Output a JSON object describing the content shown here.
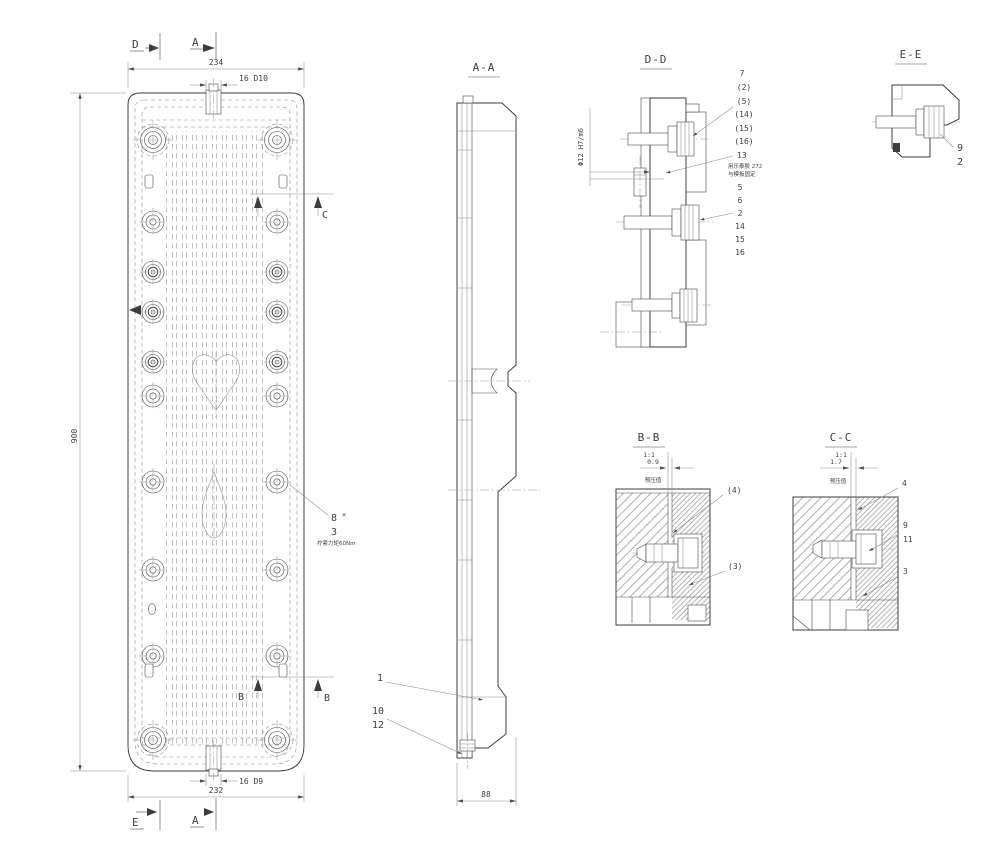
{
  "front": {
    "marker_d_top": "D",
    "marker_a_top": "A",
    "marker_e_bottom": "E",
    "marker_a_bottom": "A",
    "marker_c_right": "C",
    "marker_b_right": "B",
    "marker_b_inner": "B",
    "dim_width_top": "234",
    "dim_slot_top": "16 D10",
    "dim_height": "900",
    "dim_width_bottom": "232",
    "dim_slot_bottom": "16 D9",
    "callout_8": "8",
    "callout_8_mark": "×",
    "callout_3": "3",
    "torque_note": "拧紧力矩60Nm"
  },
  "section_aa": {
    "title": "A-A",
    "dim_depth": "88",
    "callout_1": "1",
    "callout_10": "10",
    "callout_12": "12"
  },
  "section_dd": {
    "title": "D-D",
    "fit_note": "Φ12 H7/m6",
    "callouts_upper": [
      "7",
      "(2)",
      "(5)",
      "(14)",
      "(15)",
      "(16)"
    ],
    "callout_13": "13",
    "glue_note_line1": "用乐泰胶 272",
    "glue_note_line2": "与模板固定",
    "callouts_lower": [
      "5",
      "6",
      "2",
      "14",
      "15",
      "16"
    ]
  },
  "section_ee": {
    "title": "E-E",
    "callout_9": "9",
    "callout_2": "2"
  },
  "section_bb": {
    "title": "B-B",
    "scale": "1:1",
    "dim_gap": "0.9",
    "dim_note": "预压值",
    "callout_4": "(4)",
    "callout_3": "(3)"
  },
  "section_cc": {
    "title": "C-C",
    "scale": "1:1",
    "dim_gap": "1.7",
    "dim_note": "预压值",
    "callout_4": "4",
    "callout_9": "9",
    "callout_11": "11",
    "callout_3": "3"
  }
}
